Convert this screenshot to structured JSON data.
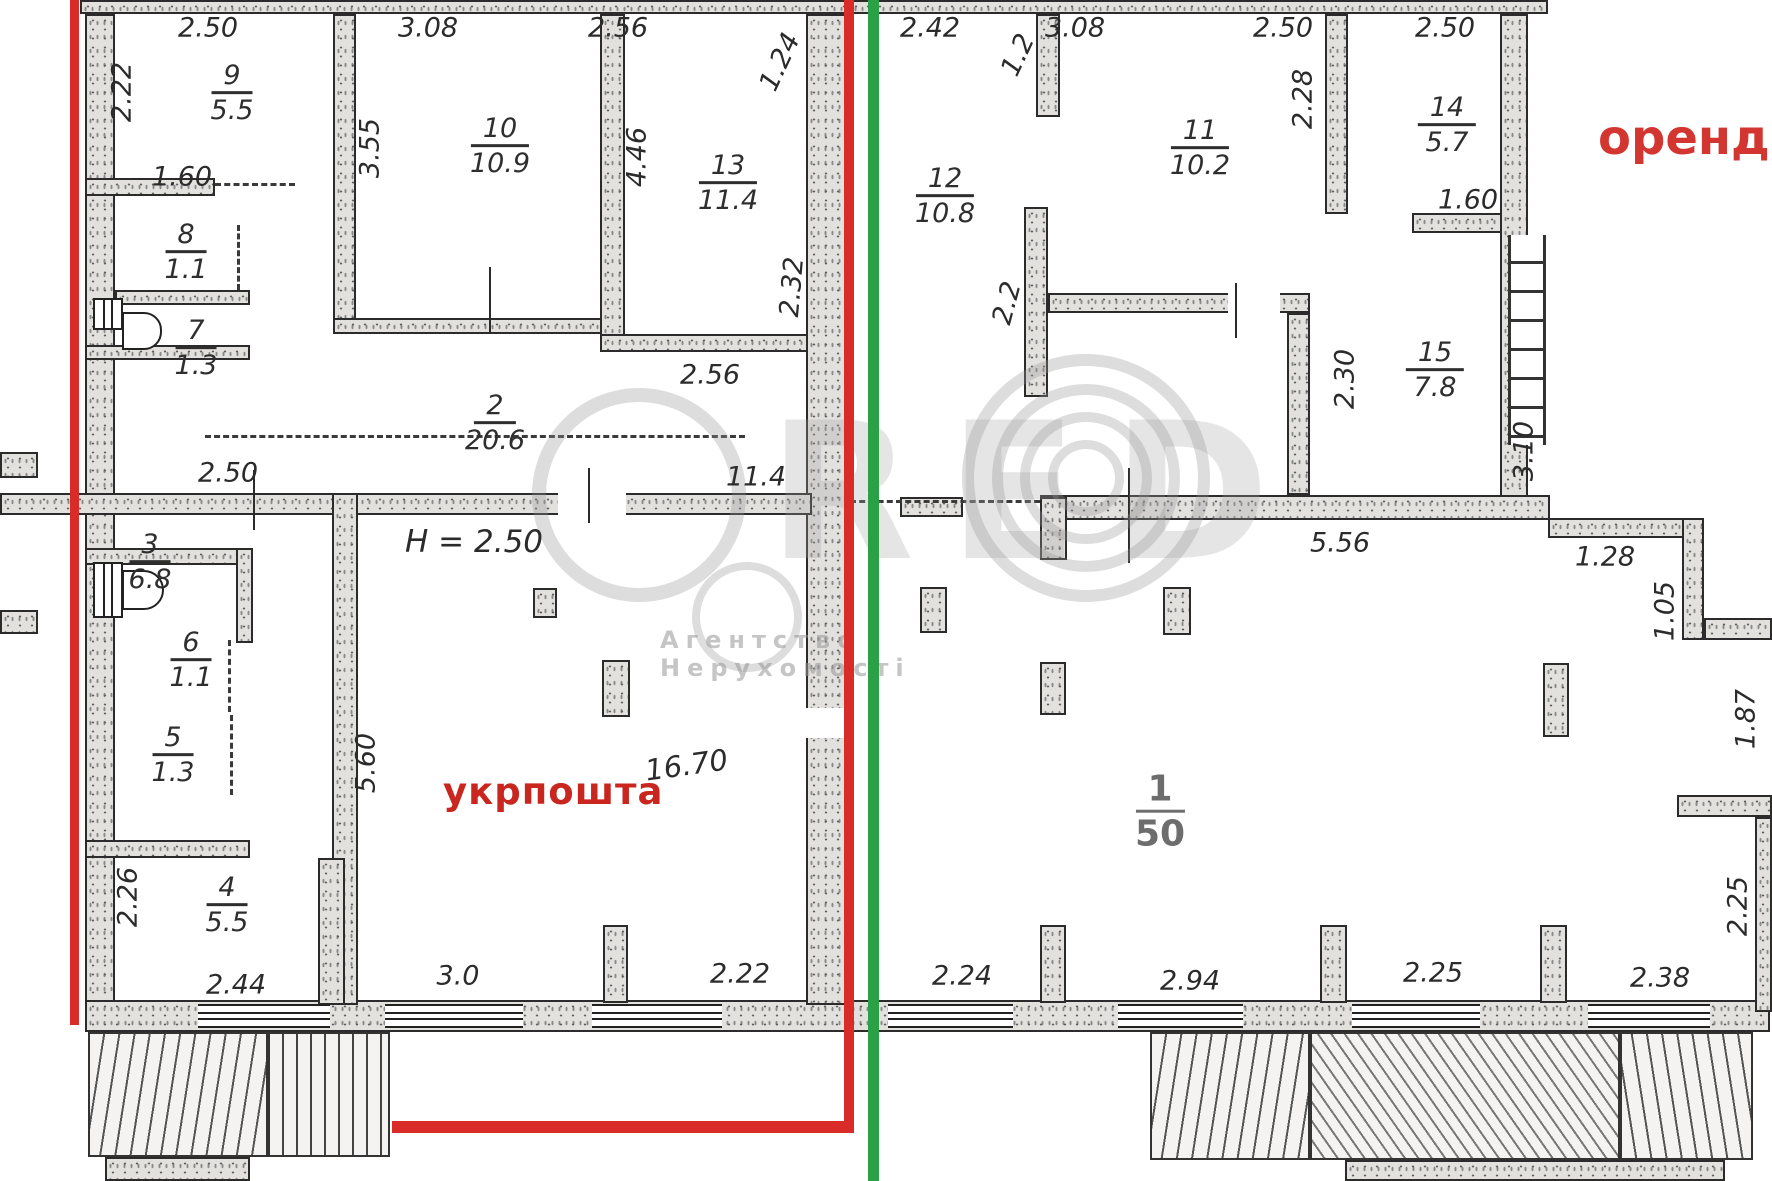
{
  "legend": {
    "ukrposhta_label": "укрпошта",
    "orenda_label": "оренда",
    "height_note": "H = 2.50",
    "mezzanine_note": "16.70"
  },
  "watermark": {
    "brand": "CRED",
    "letters_shown": "RED",
    "subtitle": "Агентство Нерухомості"
  },
  "rooms": [
    {
      "num": "1",
      "area": "50"
    },
    {
      "num": "2",
      "area": "20.6"
    },
    {
      "num": "3",
      "area": "6.8"
    },
    {
      "num": "4",
      "area": "5.5"
    },
    {
      "num": "5",
      "area": "1.3"
    },
    {
      "num": "6",
      "area": "1.1"
    },
    {
      "num": "7",
      "area": "1.3"
    },
    {
      "num": "8",
      "area": "1.1"
    },
    {
      "num": "9",
      "area": "5.5"
    },
    {
      "num": "10",
      "area": "10.9"
    },
    {
      "num": "11",
      "area": "10.2"
    },
    {
      "num": "12",
      "area": "10.8"
    },
    {
      "num": "13",
      "area": "11.4"
    },
    {
      "num": "14",
      "area": "5.7"
    },
    {
      "num": "15",
      "area": "7.8"
    }
  ],
  "dimensions": [
    "2.50",
    "3.08",
    "2.56",
    "2.42",
    "3.08",
    "2.50",
    "2.22",
    "1.60",
    "3.55",
    "4.46",
    "1.24",
    "1.2",
    "2.28",
    "2.50",
    "1.60",
    "2.32",
    "2.56",
    "2.2",
    "2.30",
    "3.10",
    "2.50",
    "11.4",
    "5.56",
    "1.28",
    "1.05",
    "1.87",
    "5.60",
    "2.26",
    "2.44",
    "3.0",
    "2.22",
    "2.24",
    "2.94",
    "2.25",
    "2.38",
    "2.25"
  ],
  "colors": {
    "red_line": "#d92b27",
    "green_line": "#2aa146",
    "red_text": "#c9261f",
    "wall_ink": "#2b2b2b"
  }
}
